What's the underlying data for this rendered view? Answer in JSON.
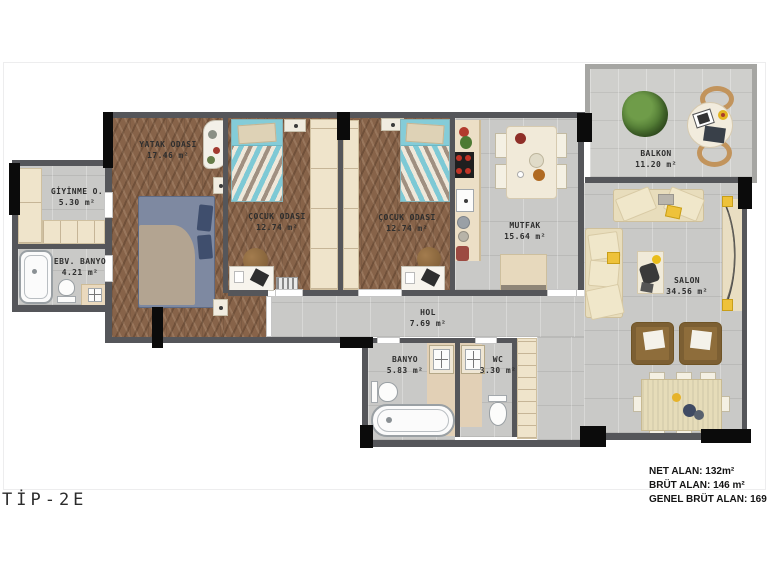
{
  "title_label": "TİP-2E",
  "summary": {
    "net": "NET ALAN: 132m²",
    "brut": "BRÜT ALAN: 146 m²",
    "genel_brut": "GENEL BRÜT ALAN: 169 m²"
  },
  "rooms": [
    {
      "name": "YATAK ODASI",
      "area": "17.46 m²"
    },
    {
      "name": "GİYİNME O.",
      "area": "5.30 m²"
    },
    {
      "name": "EBV. BANYO",
      "area": "4.21 m²"
    },
    {
      "name": "ÇOCUK ODASI",
      "area": "12.74 m²"
    },
    {
      "name": "ÇOCUK ODASI",
      "area": "12.74 m²"
    },
    {
      "name": "MUTFAK",
      "area": "15.64 m²"
    },
    {
      "name": "HOL",
      "area": "7.69 m²"
    },
    {
      "name": "BANYO",
      "area": "5.83 m²"
    },
    {
      "name": "WC",
      "area": "3.30 m²"
    },
    {
      "name": "SALON",
      "area": "34.56 m²"
    },
    {
      "name": "BALKON",
      "area": "11.20 m²"
    }
  ],
  "colors": {
    "wall": "#55565a",
    "column": "#0b0b0b",
    "wood_floor": "#876349",
    "tile_floor": "#c9c9c7",
    "accent_yellow": "#eec23a",
    "teal_bed": "#7ec9d5",
    "armchair_brown": "#8e6d3b"
  }
}
